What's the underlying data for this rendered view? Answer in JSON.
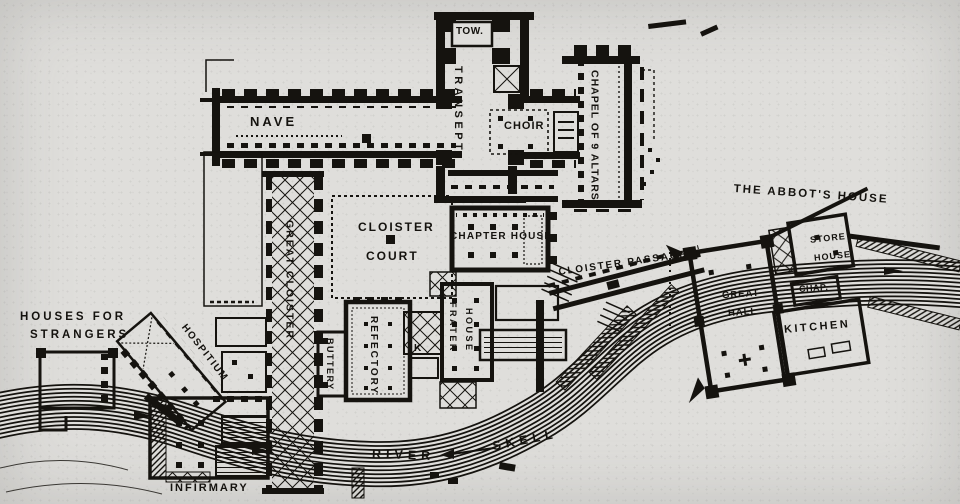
{
  "figure": {
    "type": "abbey-ground-plan",
    "colors": {
      "paper": "#dfdedb",
      "ink": "#15130f"
    }
  },
  "labels": {
    "tower": "TOW.",
    "transept": "TRANSEPT",
    "nave": "NAVE",
    "choir": "CHOIR",
    "chapel_of_nine_altars": "CHAPEL OF 9 ALTARS",
    "cloister_court_line1": "CLOISTER",
    "cloister_court_line2": "COURT",
    "chapter_house": "CHAPTER HOUSE",
    "cloister_passage": "CLOISTER PASSAGE",
    "abbots_house": "THE ABBOT'S HOUSE",
    "store_house_line1": "STORE",
    "store_house_line2": "HOUSE",
    "chapel_abbrev": "CHAP.",
    "great_hall_line1": "GREAT",
    "great_hall_line2": "HALL",
    "kitchen": "KITCHEN",
    "great_cloister": "GREAT CLOISTER",
    "buttery": "BUTTERY",
    "refectory": "REFECTORY",
    "frater_house_line1": "FRATER",
    "frater_house_line2": "HOUSE",
    "kitchen_abbrev": "K",
    "houses_for_strangers_line1": "HOUSES FOR",
    "houses_for_strangers_line2": "STRANGERS",
    "hospitium": "HOSPITIUM",
    "infirmary": "INFIRMARY",
    "river": "RIVER",
    "skell": "SKELL"
  }
}
